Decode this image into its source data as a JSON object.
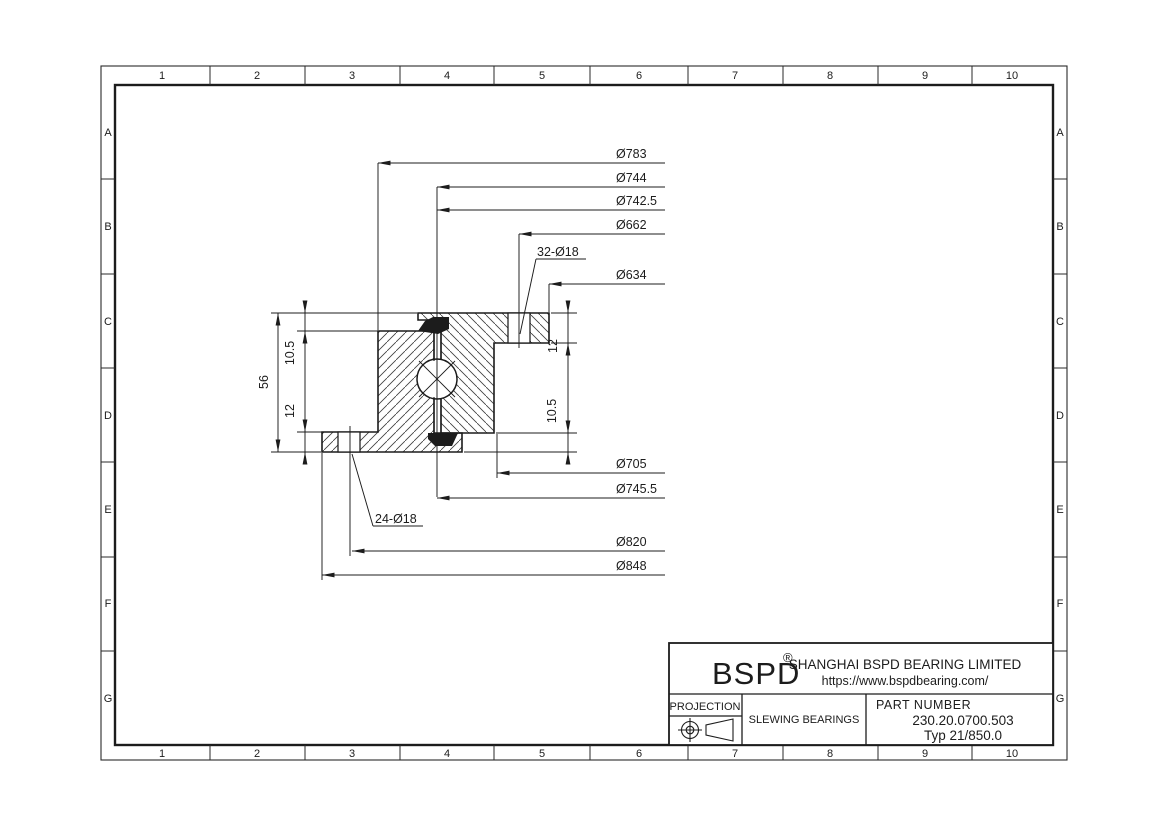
{
  "colors": {
    "line": "#1c1c1c",
    "background": "#ffffff"
  },
  "grid": {
    "columns": [
      "1",
      "2",
      "3",
      "4",
      "5",
      "6",
      "7",
      "8",
      "9",
      "10"
    ],
    "rows": [
      "A",
      "B",
      "C",
      "D",
      "E",
      "F",
      "G"
    ]
  },
  "dims": {
    "top": [
      "Ø783",
      "Ø744",
      "Ø742.5",
      "Ø662",
      "Ø634"
    ],
    "bottom": [
      "Ø705",
      "Ø745.5",
      "Ø820",
      "Ø848"
    ],
    "left": {
      "upper": "10.5",
      "height": "56",
      "lower": "12"
    },
    "right": {
      "upper": "12",
      "lower": "10.5"
    },
    "callout_top": "32-Ø18",
    "callout_bottom": "24-Ø18"
  },
  "title_block": {
    "logo": "BSPD",
    "reg_mark": "®",
    "company": "SHANGHAI BSPD BEARING LIMITED",
    "website": "https://www.bspdbearing.com/",
    "projection_label": "PROJECTION",
    "category": "SLEWING BEARINGS",
    "part_number_label": "PART  NUMBER",
    "part_number": "230.20.0700.503",
    "type_label": "Typ 21/850.0"
  }
}
